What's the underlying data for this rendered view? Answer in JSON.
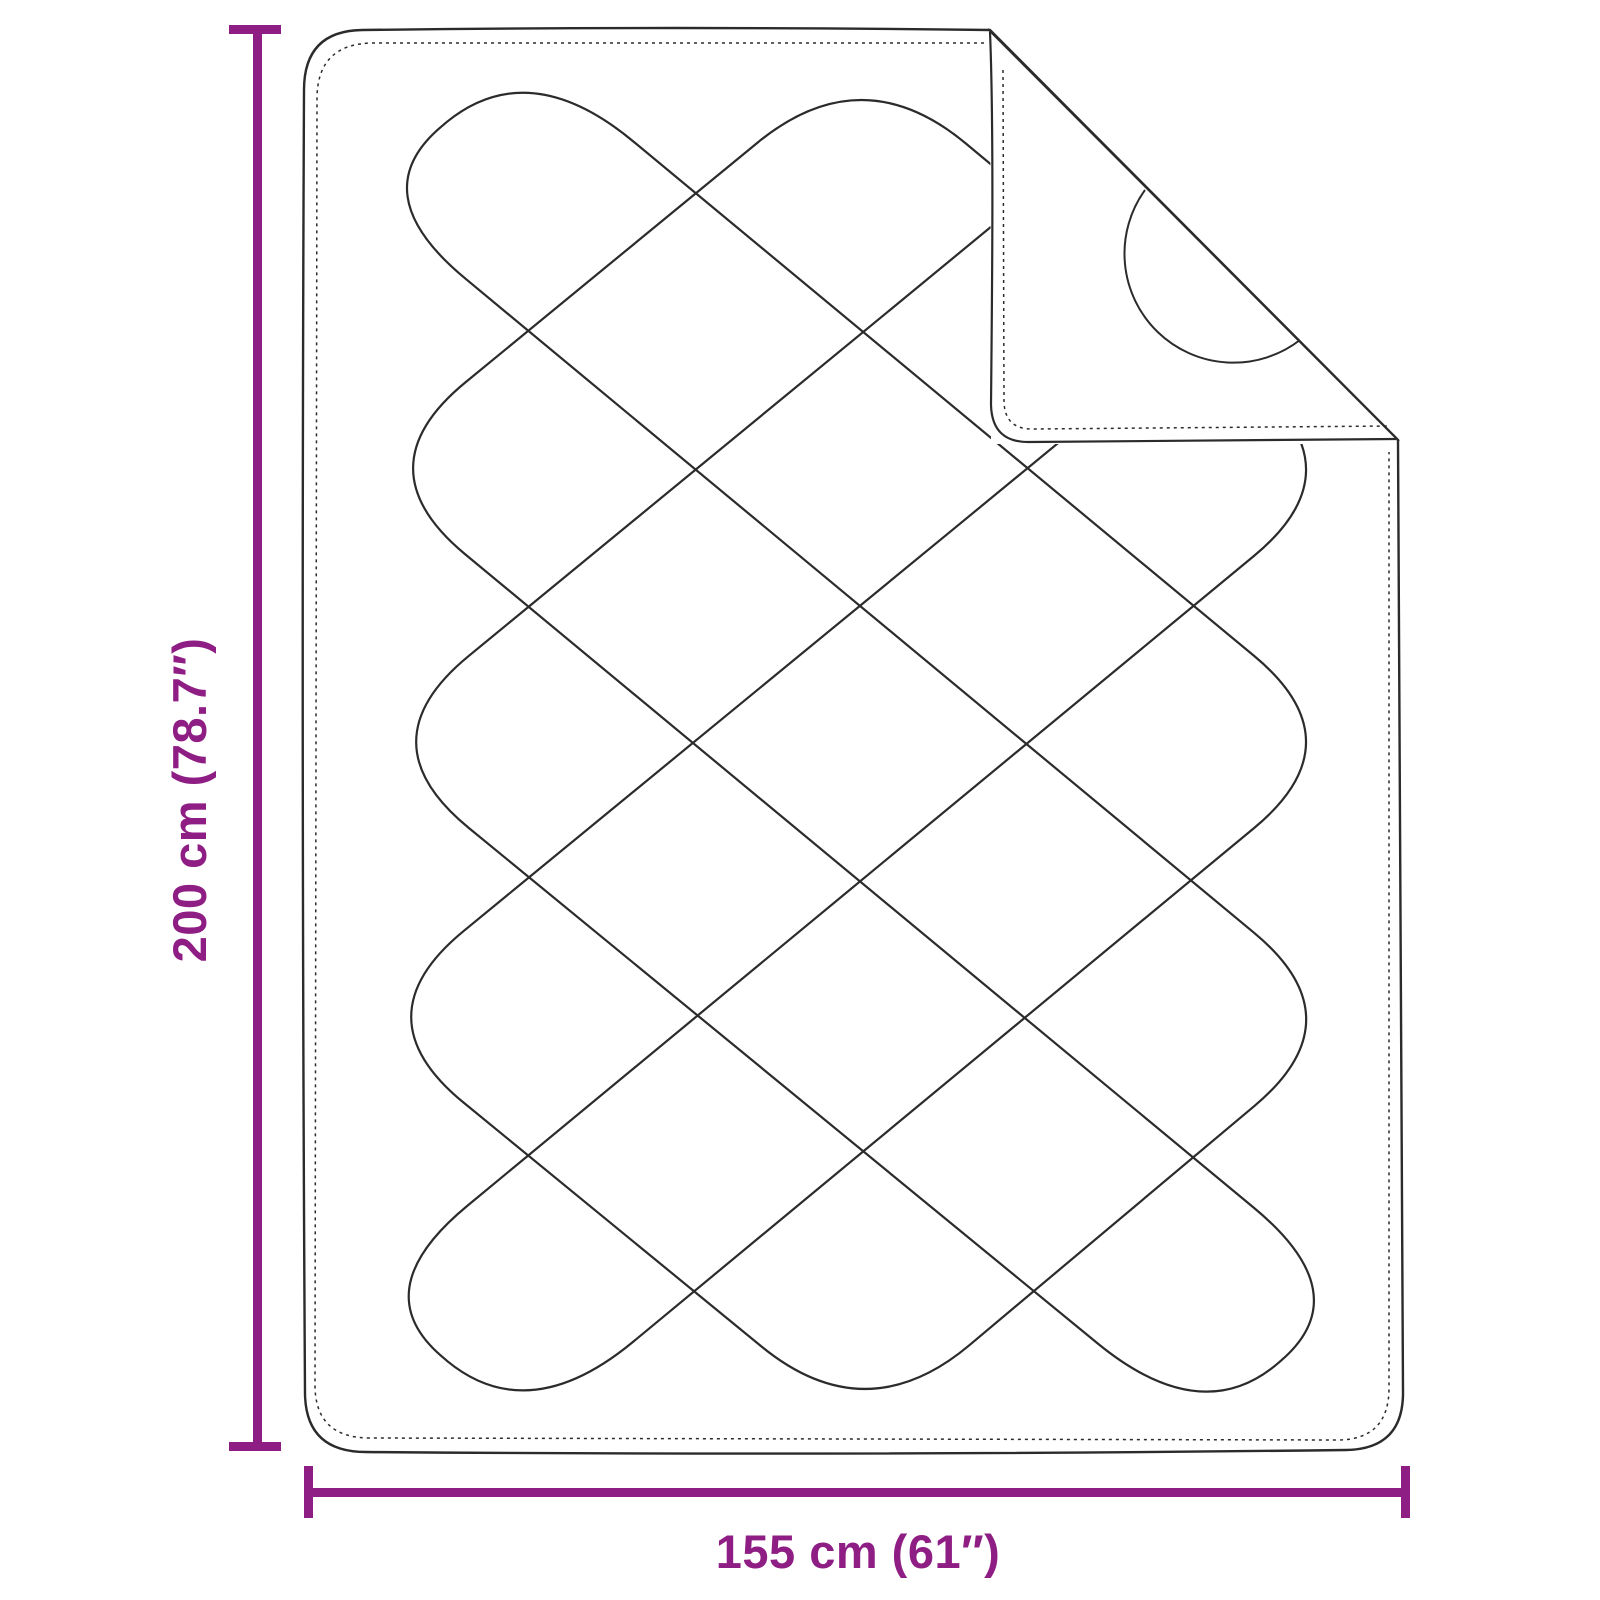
{
  "diagram": {
    "type": "product-dimension-diagram",
    "subject": "quilted-blanket-with-folded-corner",
    "height_dimension": {
      "label": "200 cm (78.7″)",
      "value_cm": 200,
      "value_inch": 78.7
    },
    "width_dimension": {
      "label": "155 cm (61″)",
      "value_cm": 155,
      "value_inch": 61
    },
    "colors": {
      "accent": "#8e1d84",
      "ink": "#2b2b2b",
      "background": "#ffffff"
    }
  }
}
